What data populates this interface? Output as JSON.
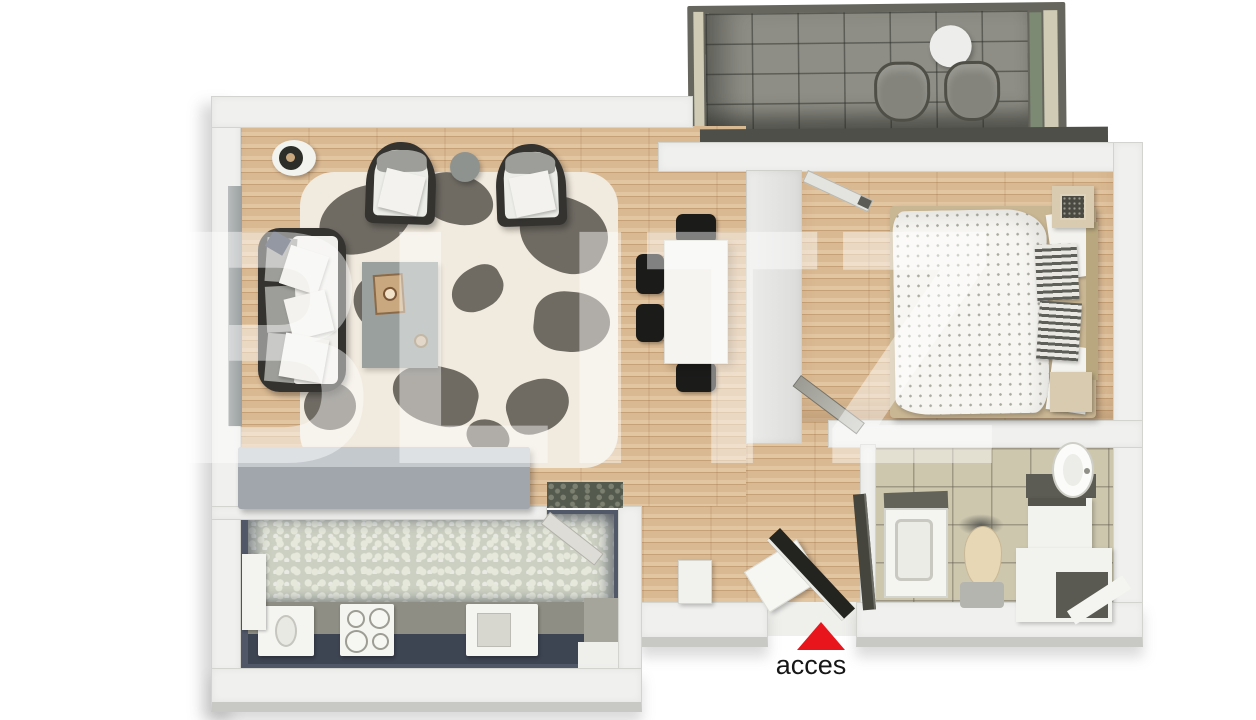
{
  "watermark": {
    "text": "BLITZ",
    "color": "rgba(255,255,255,0.45)"
  },
  "entrance": {
    "label": "acces",
    "arrow_icon": "triangle-up-icon",
    "arrow_color": "#e8161c"
  },
  "palette": {
    "wall": "#f0f0ee",
    "wall-edge": "#d3d3cf",
    "wall-shade": "#c8c8c4",
    "wood": "#d9b992",
    "wood-hi": "#e2c5a1",
    "wood-lo": "#c6a076",
    "rug-base": "#f1eade",
    "rug-patch": "#6f6b63",
    "rug-gray": "#9aa09d",
    "sofa-frame": "#343330",
    "cushion": "#9d9d99",
    "pillow": "#f3f2ee",
    "pillow-navy": "#3c4456",
    "chair-black": "#1b1b1a",
    "table-white": "#f5f4f0",
    "sideboard": "#a0a6ac",
    "sideboard-top": "#c4c9ce",
    "balc-frame": "#66665e",
    "balc-floor": "#8e8e86",
    "balc-rim": "#4f4f49",
    "balc-green": "#7c8a73",
    "balc-trim": "#cfcbb4",
    "balc-chair": "#84847c",
    "pebble": "#ccd0c2",
    "pebble-hi": "#e5e8db",
    "pebble-dark": "#555a4e",
    "counter-gray": "#8e8e84",
    "counter-navy": "#3d4452",
    "appliance": "#f4f4f1",
    "tile": "#cdc7ae",
    "shower-dark": "#63635a",
    "toilet-seat": "#e7d7b5",
    "fixture-gray": "#b5b5b0",
    "vanity-dark": "#5c5c54",
    "bed-frame": "#c9b693",
    "duvet": "#f7f6f2",
    "duvet-dot": "#abab9f",
    "stripe": "#5f5f59",
    "stripe-light": "#e9e8e3",
    "headboard": "#b9a87f",
    "nightstand": "#d8cbb0",
    "door-dark": "#23231f",
    "door-gray": "#9b9b94",
    "door-light": "#e3e3df",
    "glass": "#9aa0a2",
    "red": "#e8161c",
    "text": "#161616",
    "wm": "rgba(255,255,255,0.45)"
  }
}
